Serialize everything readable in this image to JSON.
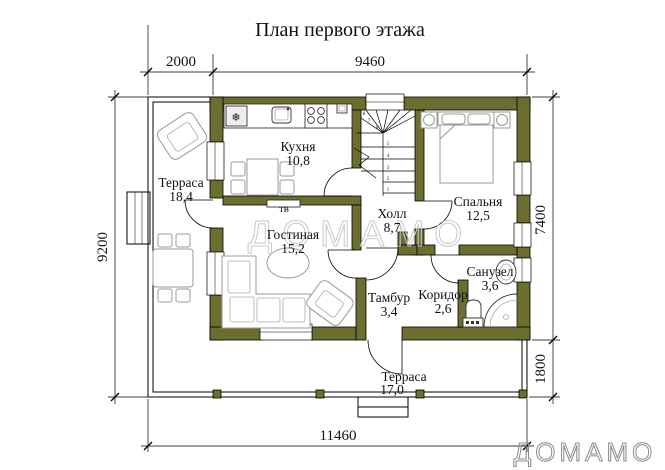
{
  "title": "План первого этажа",
  "dimensions": {
    "top_left": "2000",
    "top_right": "9460",
    "left": "9200",
    "right_main": "7400",
    "right_terrace": "1800",
    "bottom": "11460"
  },
  "rooms": {
    "terrace_left": {
      "name": "Терраса",
      "area": "18,4"
    },
    "kitchen": {
      "name": "Кухня",
      "area": "10,8"
    },
    "bedroom": {
      "name": "Спальня",
      "area": "12,5"
    },
    "living": {
      "name": "Гостиная",
      "area": "15,2"
    },
    "hall": {
      "name": "Холл",
      "area": "8,7"
    },
    "vestibule": {
      "name": "Тамбур",
      "area": "3,4"
    },
    "corridor": {
      "name": "Коридор",
      "area": "2,6"
    },
    "bathroom": {
      "name": "Санузел",
      "area": "3,6"
    },
    "terrace_bottom": {
      "name": "Терраса",
      "area": "17,0"
    }
  },
  "labels": {
    "tv": "тв"
  },
  "stairs": {
    "numbers": [
      "1",
      "2",
      "3",
      "4",
      "5",
      "6",
      "7",
      "8"
    ]
  },
  "glyphs": {
    "snowflake": "❄"
  },
  "watermark": {
    "center": "ДОМАМО",
    "corner": "ДОМАМО"
  },
  "colors": {
    "wall": "#6c6e2f",
    "paper": "#ffffff",
    "line": "#000000",
    "furniture_light": "#999999",
    "watermark_center": "#c8c8c8",
    "watermark_corner": "#8a8a8a"
  }
}
